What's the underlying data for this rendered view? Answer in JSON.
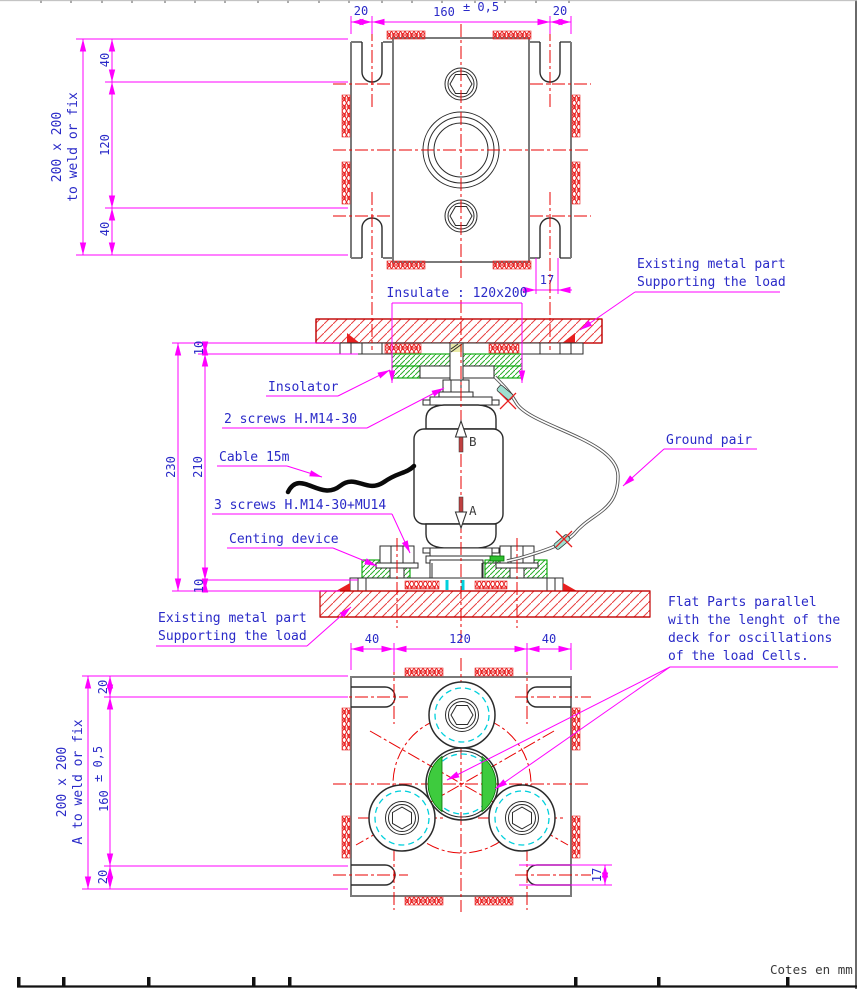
{
  "meta": {
    "units_note": "Cotes en mm"
  },
  "colors": {
    "annotation_blue": "#2a2ac8",
    "dimension_magenta": "#ff00ff",
    "centerline_red": "#e80000",
    "hatch_red": "#e82020",
    "insulator_green": "#00a400",
    "pad_cyan": "#00d0dc",
    "outline_dark": "#2b2b2b",
    "outline_gray": "#7a7a7a"
  },
  "top_view": {
    "side_label_1": "200 x 200",
    "side_label_2": "to weld or fix",
    "left_dims": {
      "top": "40",
      "middle": "120",
      "bottom": "40"
    },
    "top_dims": {
      "left": "20",
      "center_value": "160",
      "center_tol": "± 0,5",
      "right": "20"
    },
    "slot_dim": "17"
  },
  "section": {
    "existing_top_1": "Existing metal part",
    "existing_top_2": "Supporting the load",
    "insulate_dim": "Insulate : 120x200",
    "insolator": "Insolator",
    "screws_top": "2 screws H.M14-30",
    "cable": "Cable 15m",
    "ground": "Ground pair",
    "screws_bottom": "3 screws H.M14-30+MU14",
    "centring": "Centing device",
    "existing_bottom_1": "Existing metal part",
    "existing_bottom_2": "Supporting the load",
    "dims": {
      "overall": "230",
      "inner": "210",
      "top_gap": "10",
      "bottom_gap": "10"
    },
    "axis_top": "B",
    "axis_bottom": "A"
  },
  "bottom_view": {
    "side_label_1": "200 x 200",
    "side_label_2": "A to weld or fix",
    "top_dims": {
      "left": "40",
      "middle": "120",
      "right": "40"
    },
    "left_dims": {
      "top": "20",
      "center_value": "160",
      "center_tol": "± 0,5",
      "bottom": "20"
    },
    "slot_dim": "17",
    "flat_note_1": "Flat Parts parallel",
    "flat_note_2": "with the lenght of the",
    "flat_note_3": "deck for oscillations",
    "flat_note_4": "of the load Cells."
  }
}
